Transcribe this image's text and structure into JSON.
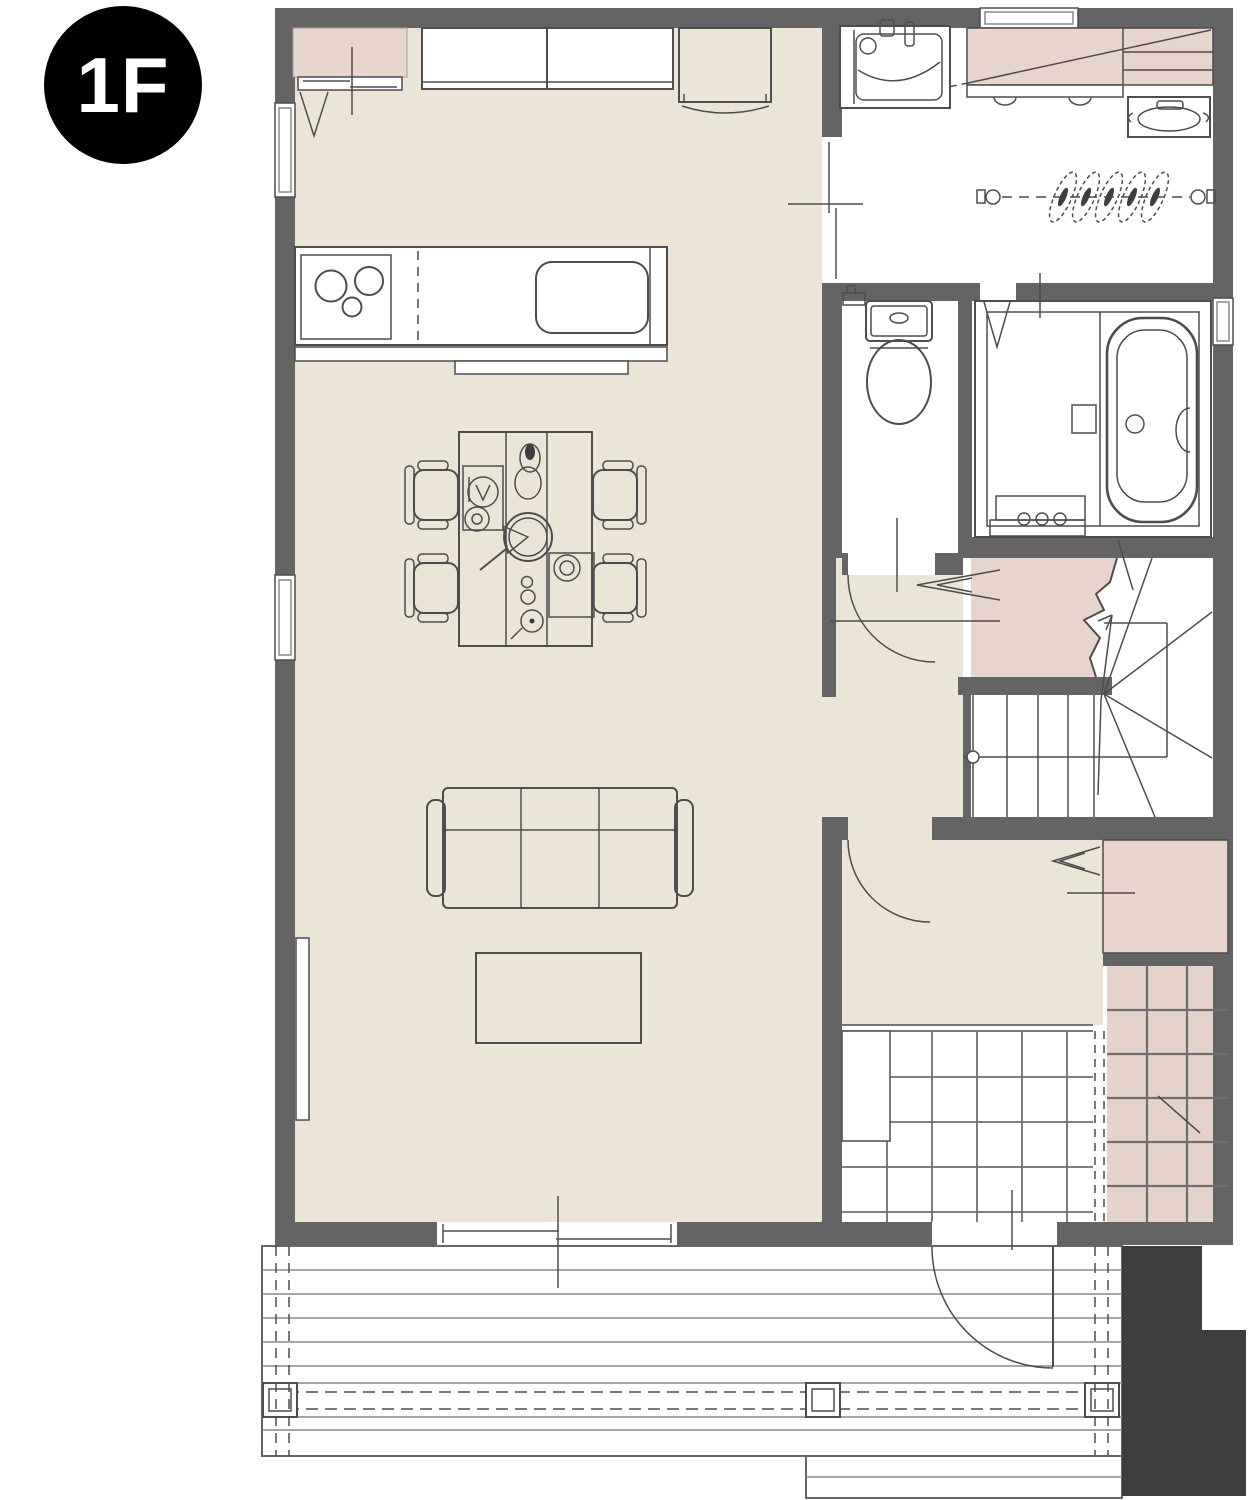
{
  "badge": {
    "label": "1F"
  },
  "colors": {
    "wall": "#646464",
    "floor": "#eae5d6",
    "pink": "#e7d4cd",
    "tilepink": "#e5d3cb",
    "dark": "#3e3e3e",
    "line": "#4d4d4d",
    "linelight": "#8a8a8a",
    "grout": "#6f6f6f"
  }
}
